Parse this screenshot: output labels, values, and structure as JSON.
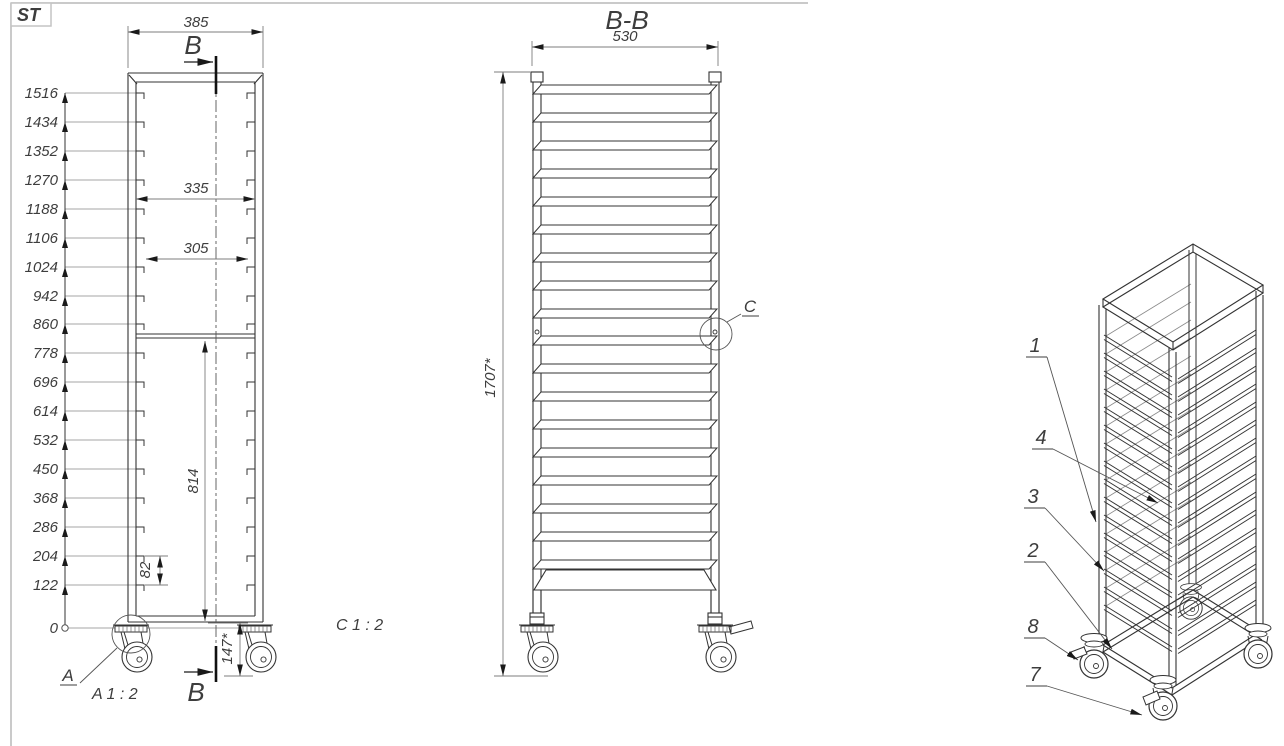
{
  "sheet": {
    "logo": "ST"
  },
  "left_view": {
    "dim_width_top": "385",
    "section_label_top": "B",
    "section_label_bottom": "B",
    "levels": [
      "1516",
      "1434",
      "1352",
      "1270",
      "1188",
      "1106",
      "1024",
      "942",
      "860",
      "778",
      "696",
      "614",
      "532",
      "450",
      "368",
      "286",
      "204",
      "122",
      "0"
    ],
    "dim_inner_width": "335",
    "dim_slot_width": "305",
    "dim_lower_height": "814",
    "dim_pitch": "82",
    "dim_caster_height": "147*",
    "detail_a_label": "A",
    "detail_a_title": "A 1 : 2",
    "detail_c_title": "C 1 : 2"
  },
  "section_view": {
    "title": "B-B",
    "dim_width": "530",
    "dim_height": "1707*",
    "detail_c_label": "C"
  },
  "iso_view": {
    "callouts": [
      "1",
      "4",
      "3",
      "2",
      "8",
      "7"
    ]
  },
  "colors": {
    "logo_red": "#d42020",
    "line_dark": "#333333",
    "dim_gray": "#7d7d7d"
  }
}
